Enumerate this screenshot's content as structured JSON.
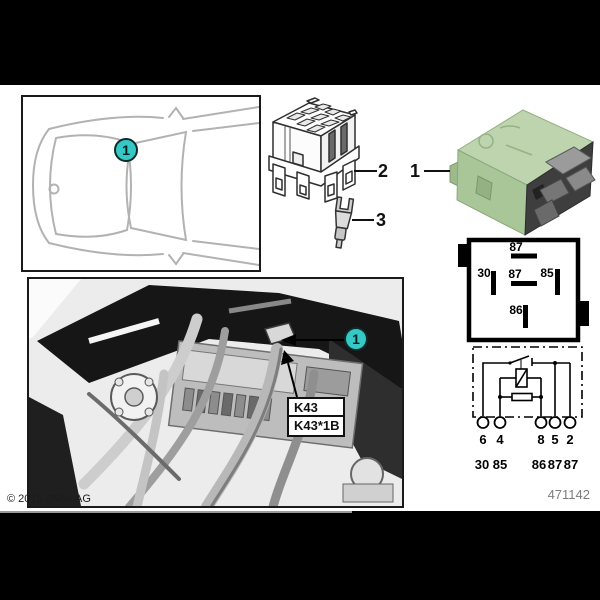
{
  "items": {
    "item1": "1",
    "item2": "2",
    "item3": "3"
  },
  "callouts": {
    "car": "1",
    "photo": "1"
  },
  "relay_label": {
    "line1": "K43",
    "line2": "K43*1B"
  },
  "pin_diagram": {
    "top": "87",
    "left": "30",
    "center": "87",
    "right": "85",
    "bottom": "86"
  },
  "schematic": {
    "terminals": [
      "6",
      "4",
      "8",
      "5",
      "2"
    ],
    "functions": [
      "30",
      "85",
      "86",
      "87",
      "87"
    ]
  },
  "footer": {
    "copyright": "© 2015 BMW AG",
    "doc_number": "471142"
  },
  "colors": {
    "callout": "#35c8c4",
    "relay_body": "#aecb9e",
    "line_art": "#1a1a1a"
  }
}
